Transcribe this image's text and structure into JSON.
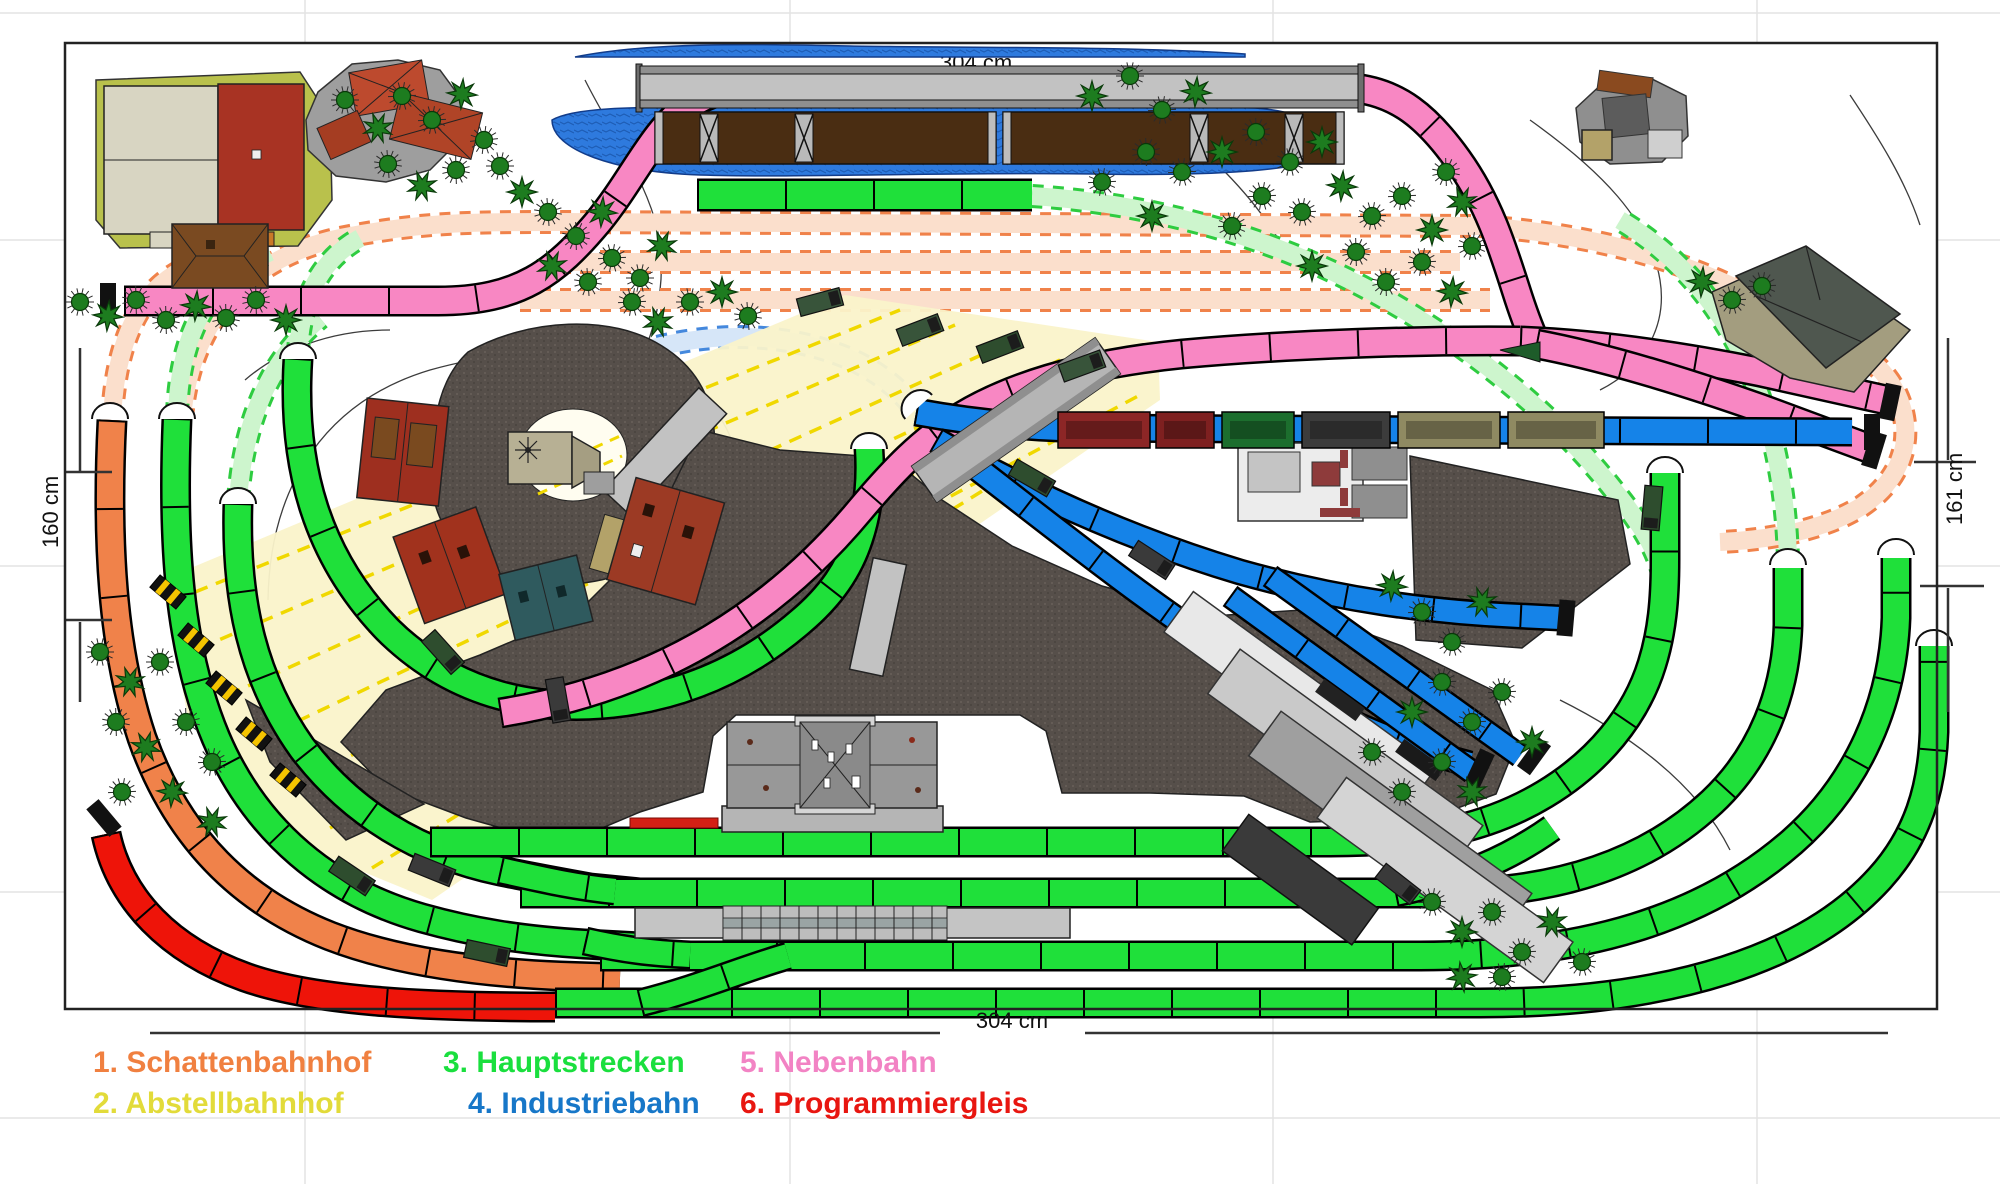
{
  "title": "Modellbahn Gleisplan",
  "dimensions": {
    "left": "160 cm",
    "right": "161 cm",
    "bottom": "304 cm",
    "top_partial": "304 cm"
  },
  "legend": {
    "items": [
      {
        "name": "schattenbahnhof",
        "label": "1. Schattenbahnhof",
        "color": "#F08040",
        "x": 93,
        "y": 1046
      },
      {
        "name": "abstellbahnhof",
        "label": "2. Abstellbahnhof",
        "color": "#E2DB3A",
        "x": 93,
        "y": 1087
      },
      {
        "name": "hauptstrecken",
        "label": "3. Hauptstrecken",
        "color": "#1ADF3E",
        "x": 443,
        "y": 1046
      },
      {
        "name": "industriebahn",
        "label": "4. Industriebahn",
        "color": "#1777C8",
        "x": 468,
        "y": 1087
      },
      {
        "name": "nebenbahn",
        "label": "5. Nebenbahn",
        "color": "#F283C4",
        "x": 740,
        "y": 1046
      },
      {
        "name": "programmiergleis",
        "label": "6. Programmiergleis",
        "color": "#E81610",
        "x": 740,
        "y": 1087
      }
    ]
  },
  "track_colors": {
    "schattenbahnhof": "#F0824A",
    "abstellbahnhof": "#F0D800",
    "hauptstrecken": "#1FE03A",
    "industriebahn": "#1583E8",
    "nebenbahn": "#F887C3",
    "programmiergleis": "#EE1409"
  },
  "scene": {
    "trees": [
      [
        345,
        100,
        "r"
      ],
      [
        378,
        128,
        "s"
      ],
      [
        402,
        96,
        "r"
      ],
      [
        432,
        120,
        "r"
      ],
      [
        462,
        94,
        "s"
      ],
      [
        484,
        140,
        "r"
      ],
      [
        388,
        164,
        "r"
      ],
      [
        422,
        186,
        "s"
      ],
      [
        456,
        170,
        "r"
      ],
      [
        500,
        166,
        "r"
      ],
      [
        522,
        192,
        "s"
      ],
      [
        548,
        212,
        "r"
      ],
      [
        576,
        236,
        "r"
      ],
      [
        602,
        212,
        "s"
      ],
      [
        612,
        258,
        "r"
      ],
      [
        640,
        278,
        "r"
      ],
      [
        662,
        246,
        "s"
      ],
      [
        588,
        282,
        "r"
      ],
      [
        552,
        266,
        "s"
      ],
      [
        632,
        302,
        "r"
      ],
      [
        658,
        322,
        "s"
      ],
      [
        690,
        302,
        "r"
      ],
      [
        722,
        292,
        "s"
      ],
      [
        748,
        316,
        "r"
      ],
      [
        80,
        302,
        "r"
      ],
      [
        108,
        316,
        "s"
      ],
      [
        136,
        300,
        "r"
      ],
      [
        166,
        320,
        "r"
      ],
      [
        196,
        306,
        "s"
      ],
      [
        226,
        318,
        "r"
      ],
      [
        256,
        300,
        "r"
      ],
      [
        286,
        320,
        "s"
      ],
      [
        1092,
        96,
        "s"
      ],
      [
        1130,
        76,
        "r"
      ],
      [
        1162,
        110,
        "r"
      ],
      [
        1196,
        92,
        "s"
      ],
      [
        1146,
        152,
        "r"
      ],
      [
        1182,
        172,
        "r"
      ],
      [
        1222,
        152,
        "s"
      ],
      [
        1256,
        132,
        "r"
      ],
      [
        1290,
        162,
        "r"
      ],
      [
        1322,
        142,
        "s"
      ],
      [
        1262,
        196,
        "r"
      ],
      [
        1302,
        212,
        "r"
      ],
      [
        1342,
        186,
        "s"
      ],
      [
        1372,
        216,
        "r"
      ],
      [
        1402,
        196,
        "r"
      ],
      [
        1432,
        230,
        "s"
      ],
      [
        1356,
        252,
        "r"
      ],
      [
        1312,
        266,
        "s"
      ],
      [
        1386,
        282,
        "r"
      ],
      [
        1422,
        262,
        "r"
      ],
      [
        1452,
        292,
        "s"
      ],
      [
        1472,
        246,
        "r"
      ],
      [
        1232,
        226,
        "r"
      ],
      [
        1152,
        216,
        "s"
      ],
      [
        1102,
        182,
        "r"
      ],
      [
        1702,
        282,
        "s"
      ],
      [
        1732,
        300,
        "r"
      ],
      [
        1762,
        286,
        "r"
      ],
      [
        1446,
        172,
        "r"
      ],
      [
        1462,
        202,
        "s"
      ],
      [
        1392,
        586,
        "s"
      ],
      [
        1422,
        612,
        "r"
      ],
      [
        1452,
        642,
        "r"
      ],
      [
        1482,
        602,
        "s"
      ],
      [
        1442,
        682,
        "r"
      ],
      [
        1412,
        712,
        "s"
      ],
      [
        1472,
        722,
        "r"
      ],
      [
        1502,
        692,
        "r"
      ],
      [
        1532,
        742,
        "s"
      ],
      [
        1442,
        762,
        "r"
      ],
      [
        1402,
        792,
        "r"
      ],
      [
        1472,
        792,
        "s"
      ],
      [
        1372,
        752,
        "r"
      ],
      [
        1432,
        902,
        "r"
      ],
      [
        1462,
        932,
        "s"
      ],
      [
        1492,
        912,
        "r"
      ],
      [
        1522,
        952,
        "r"
      ],
      [
        1552,
        922,
        "s"
      ],
      [
        1502,
        977,
        "r"
      ],
      [
        1462,
        977,
        "s"
      ],
      [
        1582,
        962,
        "r"
      ],
      [
        100,
        652,
        "r"
      ],
      [
        130,
        682,
        "s"
      ],
      [
        160,
        662,
        "r"
      ],
      [
        116,
        722,
        "r"
      ],
      [
        146,
        747,
        "s"
      ],
      [
        186,
        722,
        "r"
      ],
      [
        212,
        762,
        "r"
      ],
      [
        172,
        792,
        "s"
      ],
      [
        122,
        792,
        "r"
      ],
      [
        212,
        822,
        "s"
      ]
    ],
    "locomotives": [
      [
        443,
        652,
        48,
        "#2e4d2e"
      ],
      [
        558,
        700,
        80,
        "#3a3a3a"
      ],
      [
        352,
        876,
        34,
        "#2e4d2e"
      ],
      [
        432,
        870,
        22,
        "#3a3a3a"
      ],
      [
        487,
        953,
        12,
        "#2e4d2e"
      ],
      [
        1398,
        884,
        38,
        "#3a3a3a"
      ],
      [
        1652,
        508,
        95,
        "#2e4d2e"
      ],
      [
        920,
        330,
        -21,
        "#38543a"
      ],
      [
        1000,
        347,
        -21,
        "#2e4d2e"
      ],
      [
        1082,
        366,
        -20,
        "#38543a"
      ],
      [
        1032,
        478,
        30,
        "#2e4d2e"
      ],
      [
        1152,
        560,
        33,
        "#3a3a3a"
      ],
      [
        820,
        302,
        -15,
        "#38543a"
      ]
    ],
    "warning_cars": [
      [
        168,
        592
      ],
      [
        196,
        640
      ],
      [
        224,
        688
      ],
      [
        254,
        734
      ],
      [
        288,
        780
      ]
    ],
    "buffer_stops": [
      [
        108,
        301,
        0
      ],
      [
        104,
        818,
        -40
      ],
      [
        1890,
        402,
        12
      ],
      [
        1874,
        450,
        17
      ],
      [
        1872,
        432,
        0
      ],
      [
        1566,
        618,
        5
      ],
      [
        1480,
        768,
        25
      ],
      [
        1534,
        756,
        36
      ]
    ],
    "tunnel_portals": [
      [
        110,
        415,
        0
      ],
      [
        177,
        415,
        0
      ],
      [
        238,
        500,
        0
      ],
      [
        298,
        355,
        0
      ],
      [
        869,
        445,
        0
      ],
      [
        916,
        404,
        -42
      ],
      [
        1665,
        469,
        0
      ],
      [
        1788,
        561,
        0
      ],
      [
        1896,
        551,
        0
      ],
      [
        1934,
        642,
        0
      ]
    ],
    "train_wagons": [
      [
        1058,
        92,
        "#8c2626"
      ],
      [
        1156,
        58,
        "#7e2020"
      ],
      [
        1222,
        72,
        "#1c6e2e"
      ],
      [
        1302,
        88,
        "#3c3c3c"
      ],
      [
        1398,
        102,
        "#8f8a62"
      ],
      [
        1508,
        96,
        "#8f8a62"
      ]
    ]
  }
}
